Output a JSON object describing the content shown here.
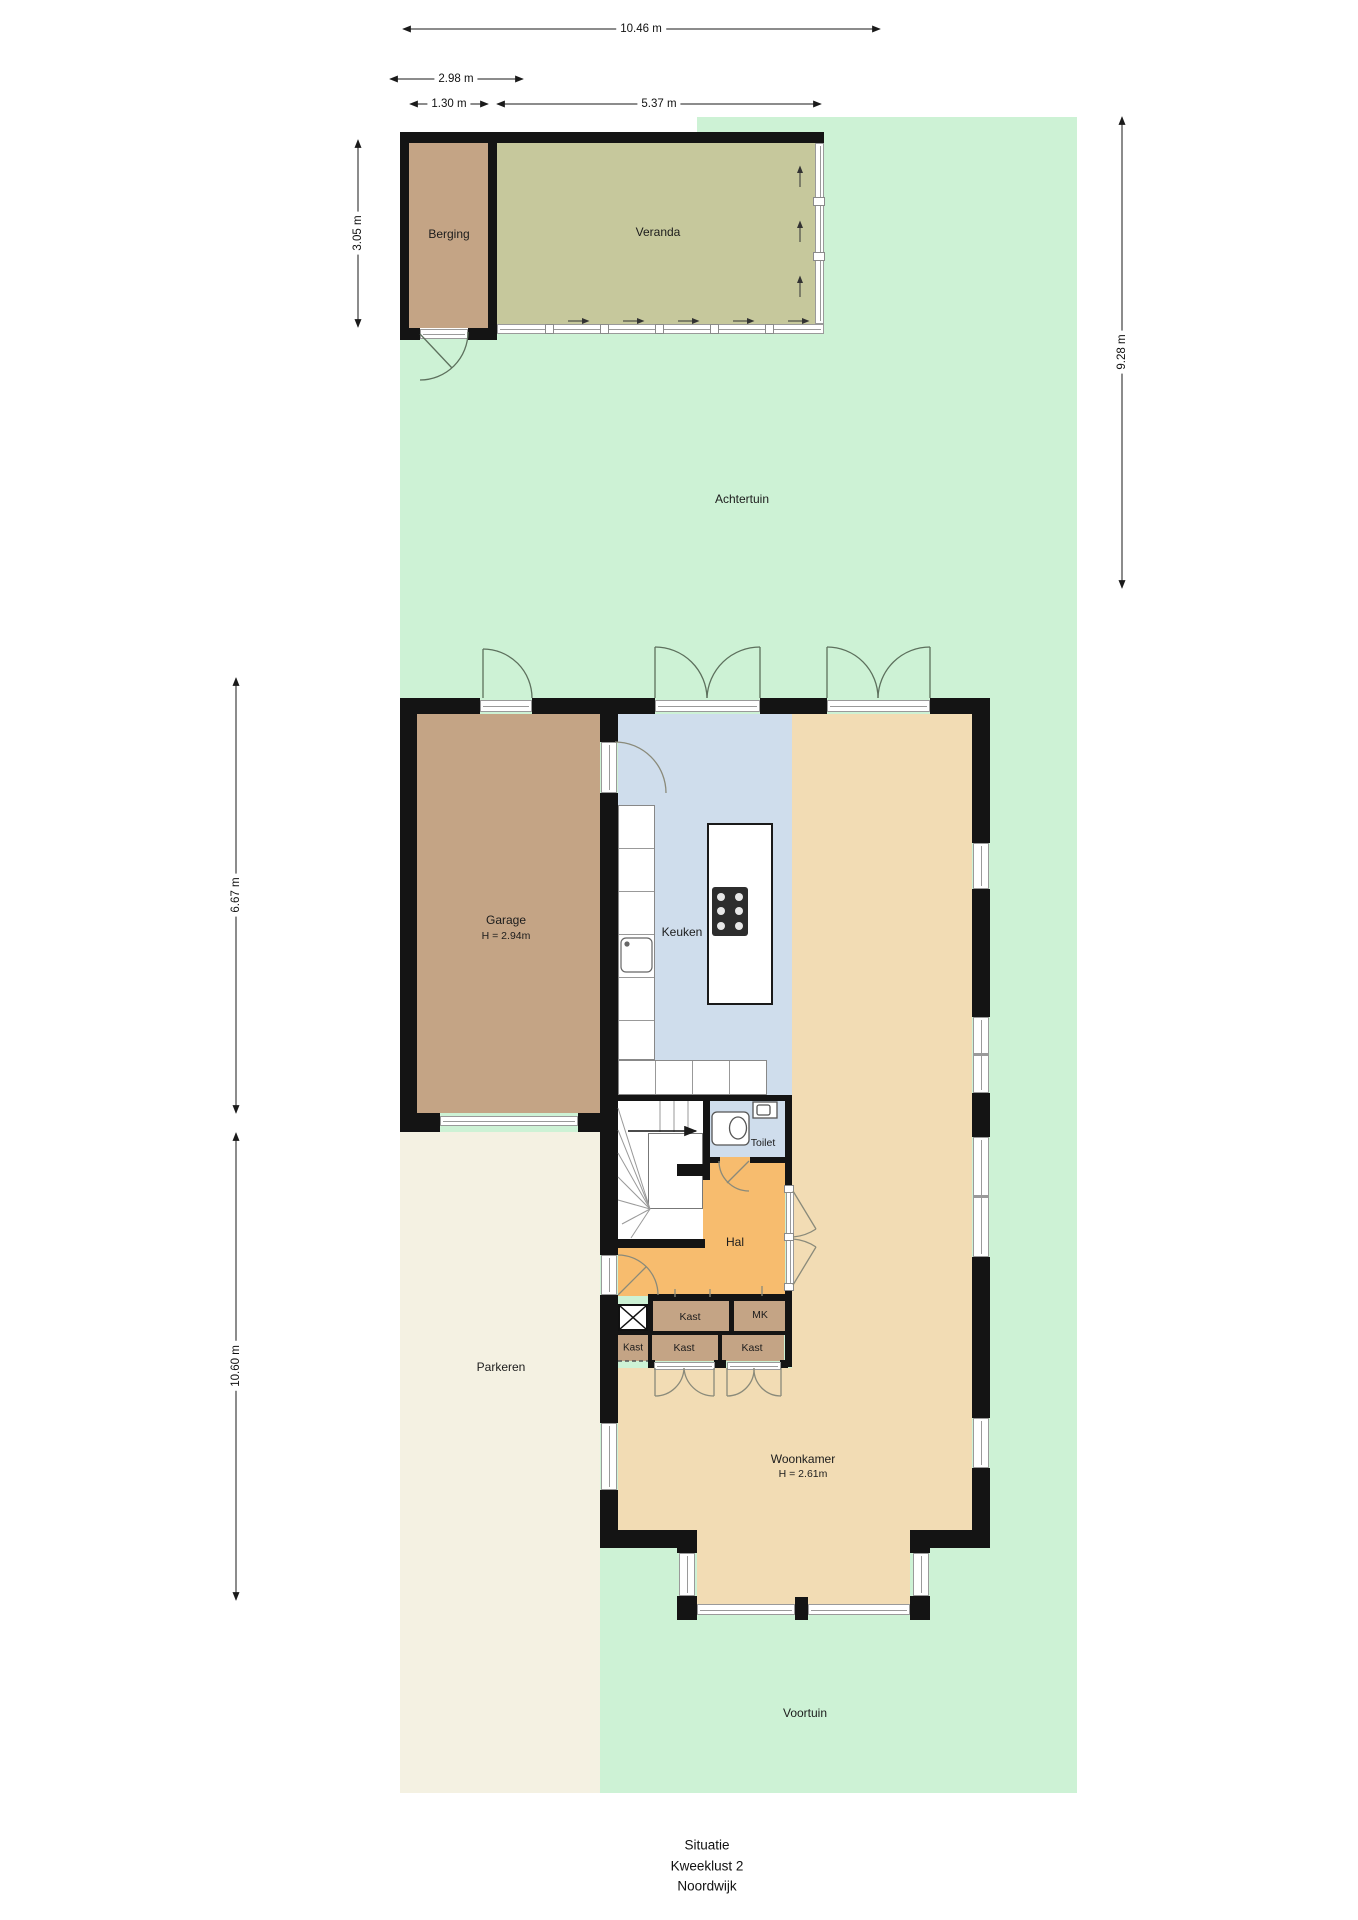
{
  "plan_title": [
    "Situatie",
    "Kweeklust 2",
    "Noordwijk"
  ],
  "rooms": {
    "achtertuin": "Achtertuin",
    "voortuin": "Voortuin",
    "parkeren": "Parkeren",
    "berging": "Berging",
    "veranda": "Veranda",
    "garage": "Garage",
    "garage_height": "H = 2.94m",
    "keuken": "Keuken",
    "toilet": "Toilet",
    "hal": "Hal",
    "kast": "Kast",
    "mk": "MK",
    "woonkamer": "Woonkamer",
    "woonkamer_height": "H = 2.61m"
  },
  "dimensions": {
    "garden_width": "10.46 m",
    "outbuilding_width": "2.98 m",
    "berging_width": "1.30 m",
    "veranda_width": "5.37 m",
    "berging_depth": "3.05 m",
    "garden_depth": "9.28 m",
    "garage_depth": "6.67 m",
    "front_depth": "10.60 m"
  },
  "colors": {
    "garden": "#cdf2d5",
    "veranda_floor": "#c6c89c",
    "storage_brown": "#c4a485",
    "kitchen_blue": "#cfddec",
    "living_tan": "#f2dcb4",
    "hall_orange": "#f7bc6e",
    "parking_cream": "#f4f1e2",
    "wall_black": "#141414",
    "door_arc": "#5d705d",
    "interior_line": "#8a8a7a"
  }
}
